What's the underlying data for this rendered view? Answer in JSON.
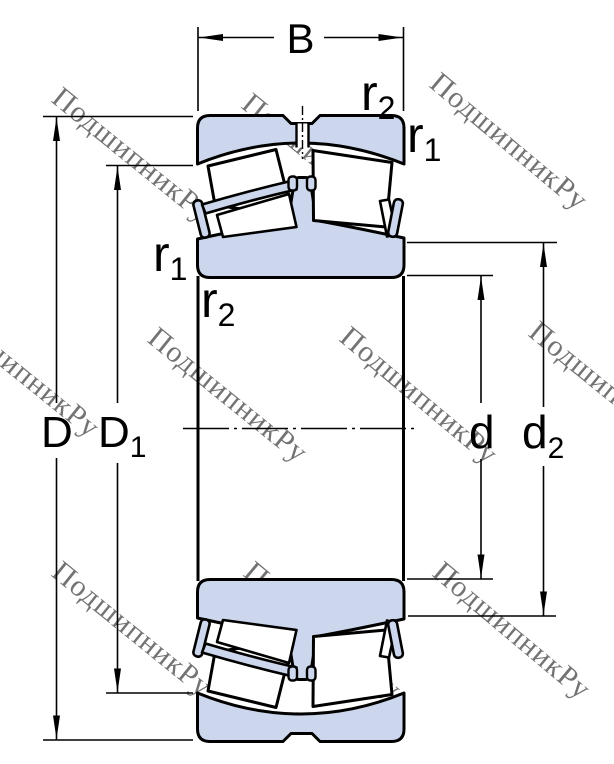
{
  "watermark": {
    "text": "ПодшипникРу"
  },
  "labels": {
    "width": "B",
    "outer_diameter": "D",
    "outer_shoulder_main": "D",
    "outer_shoulder_sub": "1",
    "bore": "d",
    "inner_shoulder_main": "d",
    "inner_shoulder_sub": "2",
    "fillet1_main": "r",
    "fillet1_sub": "1",
    "fillet2_main": "r",
    "fillet2_sub": "2"
  },
  "colors": {
    "ring_fill": "#ccd6ec",
    "roller_fill": "#ffffff",
    "line": "#000000",
    "watermark": "#c5c5c5"
  }
}
